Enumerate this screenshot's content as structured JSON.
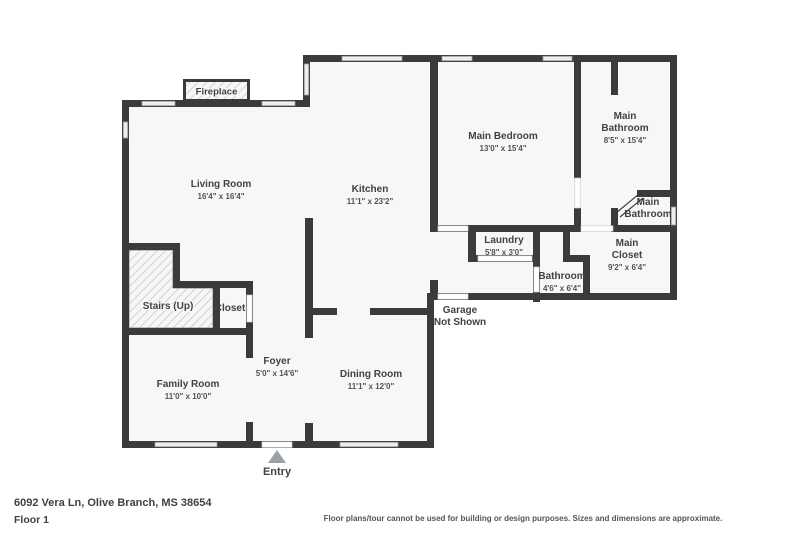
{
  "meta": {
    "address": "6092 Vera Ln, Olive Branch, MS 38654",
    "floor_label": "Floor 1",
    "disclaimer": "Floor plans/tour cannot be used for building or design purposes. Sizes and dimensions are approximate."
  },
  "entry": {
    "label": "Entry"
  },
  "fireplace": {
    "label": "Fireplace"
  },
  "colors": {
    "wall": "#3b3b3b",
    "floor": "#f7f7f7",
    "window_fill": "#ededed",
    "door_fill": "#ffffff",
    "text": "#3e4347",
    "entry_arrow": "#9aa2a6"
  },
  "rooms": [
    {
      "id": "living-room",
      "name": "Living Room",
      "dims": "16'4\" x 16'4\"",
      "x": 221,
      "y": 187
    },
    {
      "id": "kitchen",
      "name": "Kitchen",
      "dims": "11'1\" x 23'2\"",
      "x": 370,
      "y": 192
    },
    {
      "id": "main-bedroom",
      "name": "Main Bedroom",
      "dims": "13'0\" x 15'4\"",
      "x": 503,
      "y": 139
    },
    {
      "id": "main-bathroom",
      "lines": [
        "Main",
        "Bathroom"
      ],
      "name": "Main Bathroom",
      "dims": "8'5\" x 15'4\"",
      "x": 625,
      "y": 119
    },
    {
      "id": "main-bathroom-small",
      "lines": [
        "Main",
        "Bathroom"
      ],
      "name": "Main Bathroom",
      "x": 648,
      "y": 205
    },
    {
      "id": "laundry",
      "name": "Laundry",
      "dims": "5'8\" x 3'0\"",
      "x": 504,
      "y": 243
    },
    {
      "id": "bathroom",
      "name": "Bathroom",
      "dims": "4'6\" x 6'4\"",
      "x": 562,
      "y": 279
    },
    {
      "id": "main-closet",
      "lines": [
        "Main",
        "Closet"
      ],
      "name": "Main Closet",
      "dims": "9'2\" x 6'4\"",
      "x": 627,
      "y": 246
    },
    {
      "id": "stairs-up",
      "name": "Stairs (Up)",
      "x": 168,
      "y": 309,
      "halo": true
    },
    {
      "id": "closet",
      "name": "Closet",
      "x": 230,
      "y": 311
    },
    {
      "id": "foyer",
      "name": "Foyer",
      "dims": "5'0\" x 14'6\"",
      "x": 277,
      "y": 364
    },
    {
      "id": "dining-room",
      "name": "Dining Room",
      "dims": "11'1\" x 12'0\"",
      "x": 371,
      "y": 377
    },
    {
      "id": "family-room",
      "name": "Family Room",
      "dims": "11'0\" x 10'0\"",
      "x": 188,
      "y": 387
    },
    {
      "id": "garage-note",
      "lines": [
        "Garage",
        "Not Shown"
      ],
      "name": "Garage Not Shown",
      "x": 460,
      "y": 313
    }
  ]
}
